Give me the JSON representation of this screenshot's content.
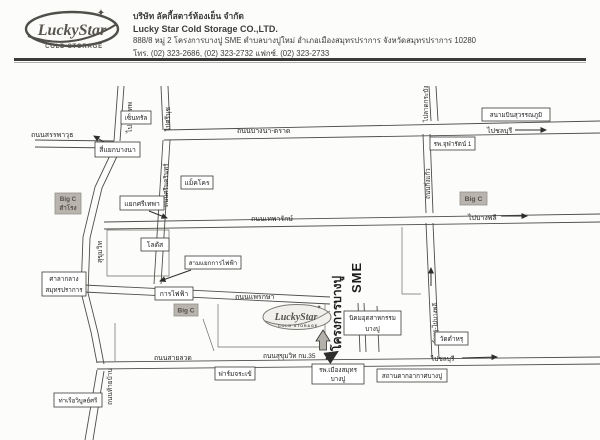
{
  "logo": {
    "brand": "LuckyStar",
    "cold_storage": "COLD STORAGE",
    "star": "✦"
  },
  "header": {
    "company_th": "บริษัท ลัคกี้สตาร์ห้องเย็น จำกัด",
    "company_en": "Lucky Star Cold Storage CO.,LTD.",
    "address": "888/8 หมู่ 2 โครงการบางปู SME ตำบลบางปูใหม่ อำเภอเมืองสมุทรปราการ จังหวัดสมุทรปราการ 10280",
    "phone": "โทร. (02) 323-2686, (02) 323-2732 แฟกซ์. (02) 323-2733"
  },
  "map": {
    "roads": {
      "to_bangkok": "ไปกรุงเทพ",
      "sanphawut": "ถนนสรรพาวุธ",
      "bangna_trat": "ถนนบางนา-ตราด",
      "to_srinuch": "ไปศรีนุช",
      "to_latkrabang": "ไปลาดกระบัง",
      "to_chonburi_top": "ไปชลบุรี",
      "kingkaeo": "ถนนกิ่งแก้ว",
      "theparak": "ถนนเทพารักษ์",
      "to_bangphli": "ไปบางพลี",
      "srinakarin": "ถนนศรีนครินทร์",
      "sukhumvit": "สุขุมวิท",
      "phraeksa": "ถนนแพรกษา",
      "tamru_bangphli": "ตำหรุ-ไปบางพลี",
      "sailuat": "ถนนสายลวด",
      "sukhumvit_km35": "ถนนสุขุมวิท กม.35",
      "to_chonburi_bottom": "ไปชลบุรี",
      "thaiban": "ถนนท้ายบ้าน",
      "project_bangpu": "โครงการบางปู",
      "sme": "SME"
    },
    "places": {
      "central": "เซ็นทรัล",
      "bangna_intersection": "สี่แยกบางนา",
      "suvarnabhumi": "สนามบินสุวรรณภูมิ",
      "chularat": "รพ.จุฬารัตน์ 1",
      "makro": "แม็คโคร",
      "bigc_kingkaeo": "Big C",
      "bigc_samrong_1": "Big C",
      "bigc_samrong_2": "สำโรง",
      "srithepha": "แยกศรีเทพา",
      "lotus": "โลตัส",
      "samyaek_kanfaifa": "สามแยกการไฟฟ้า",
      "kanfaifa": "การไฟฟ้า",
      "cityhall_1": "ศาลากลาง",
      "cityhall_2": "สมุทรปราการ",
      "bigc_paknam": "Big C",
      "nikhom_1": "นิคมอุตสาหกรรม",
      "nikhom_2": "บางปู",
      "wat_tamru": "วัดตำหรุ",
      "crocodile_farm": "ฟาร์มจระเข้",
      "hospital_1": "รพ.เมืองสมุทร",
      "hospital_2": "บางปู",
      "bangpu_resort": "สถานตากอากาศบางปู",
      "pier": "ท่าเรือวิบูลย์ศรี"
    }
  }
}
